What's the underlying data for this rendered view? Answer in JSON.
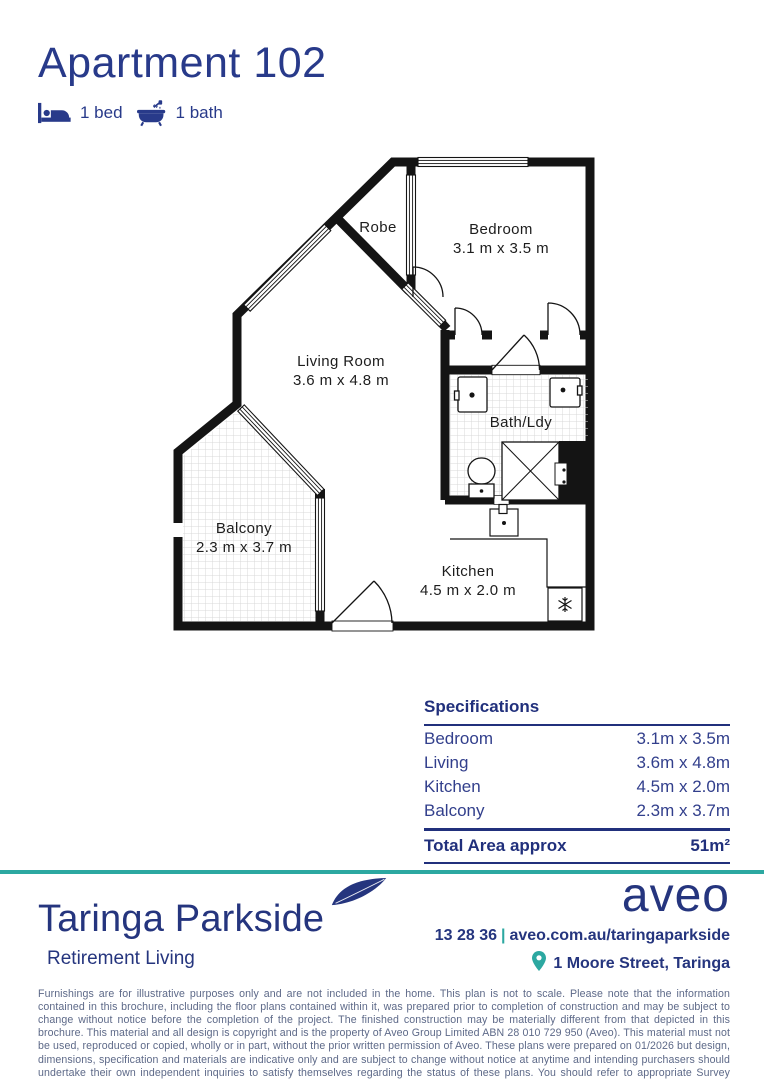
{
  "colors": {
    "navy": "#25357e",
    "title_navy": "#283a8a",
    "teal": "#2CA8A1",
    "plan_line": "#141414",
    "disclaimer_text": "#5d6988"
  },
  "header": {
    "title": "Apartment 102",
    "features": [
      {
        "icon": "bed-icon",
        "label": "1 bed"
      },
      {
        "icon": "bath-icon",
        "label": "1 bath"
      }
    ]
  },
  "floor_plan": {
    "rooms": {
      "robe": {
        "name": "Robe"
      },
      "bedroom": {
        "name": "Bedroom",
        "dims": "3.1 m x 3.5 m"
      },
      "living": {
        "name": "Living Room",
        "dims": "3.6 m x 4.8 m"
      },
      "bath": {
        "name": "Bath/Ldy"
      },
      "balcony": {
        "name": "Balcony",
        "dims": "2.3 m x 3.7 m"
      },
      "kitchen": {
        "name": "Kitchen",
        "dims": "4.5 m x 2.0 m"
      }
    }
  },
  "specifications": {
    "title": "Specifications",
    "rows": [
      {
        "label": "Bedroom",
        "value": "3.1m x 3.5m"
      },
      {
        "label": "Living",
        "value": "3.6m x 4.8m"
      },
      {
        "label": "Kitchen",
        "value": "4.5m x 2.0m"
      },
      {
        "label": "Balcony",
        "value": "2.3m x 3.7m"
      }
    ],
    "total_label": "Total Area approx",
    "total_value": "51m²"
  },
  "footer": {
    "brand": "Taringa Parkside",
    "tagline": "Retirement Living",
    "logo": "aveo",
    "phone": "13 28 36",
    "separator": "|",
    "website": "aveo.com.au/taringaparkside",
    "address": "1 Moore Street, Taringa"
  },
  "disclaimer": "Furnishings are for illustrative purposes only and are not included in the home. This plan is not to scale. Please note that the information contained in this brochure, including the floor plans contained within it, was prepared prior to completion of construction and may be subject to change without notice before the completion of the project. The finished construction may be materially different from that depicted in this brochure. This material and all design is copyright and is the property of Aveo Group Limited ABN 28 010 729 950 (Aveo). This material must not be used, reproduced or copied, wholly or in part, without the prior written permission of Aveo. These plans were prepared on 01/2026 but design, dimensions, specification and materials are indicative only and are subject to change without notice at anytime and intending purchasers should undertake their own independent inquiries to satisfy themselves regarding the status of these plans. You should refer to appropriate Survey Plans for confirmation of individual unit areas."
}
